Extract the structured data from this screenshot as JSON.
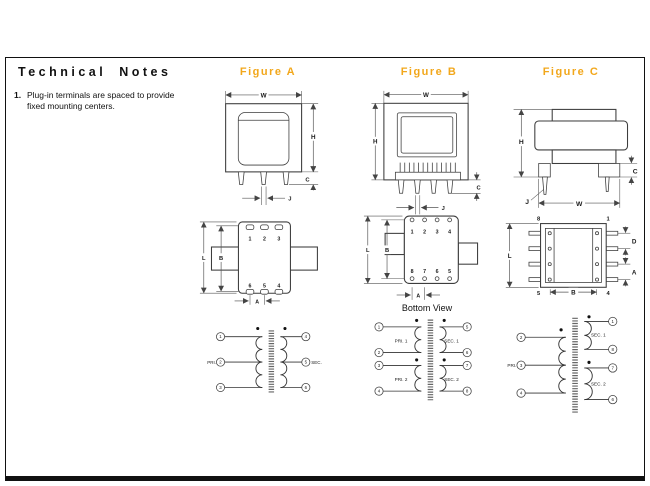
{
  "page": {
    "title": "Technical Notes",
    "note_1_num": "1.",
    "note_1_text": "Plug-in terminals are spaced to provide fixed mounting centers."
  },
  "colors": {
    "figure_title_accent": "#F2A71B",
    "line": "#444444"
  },
  "fig_a": {
    "title": "Figure A",
    "front": {
      "w": "W",
      "h": "H",
      "c": "C",
      "j": "J"
    },
    "bottom": {
      "top_pins": [
        "1",
        "2",
        "3"
      ],
      "bottom_pins": [
        "6",
        "5",
        "4"
      ],
      "l": "L",
      "b": "B",
      "a": "A"
    },
    "schem": {
      "left_pins": [
        "1",
        "2",
        "3"
      ],
      "right_pins": [
        "4",
        "5",
        "6"
      ],
      "pri": "PRI.",
      "sec": "SEC."
    }
  },
  "fig_b": {
    "title": "Figure B",
    "front": {
      "w": "W",
      "h": "H",
      "c": "C",
      "j": "J"
    },
    "bottom": {
      "caption": "Bottom View",
      "top_pins": [
        "1",
        "2",
        "3",
        "4"
      ],
      "bottom_pins": [
        "8",
        "7",
        "6",
        "5"
      ],
      "l": "L",
      "b": "B",
      "a": "A"
    },
    "schem": {
      "left_pins": [
        "1",
        "2",
        "3",
        "4"
      ],
      "right_pins": [
        "5",
        "6",
        "7",
        "8"
      ],
      "pri1": "PRI. 1",
      "pri2": "PRI. 2",
      "sec1": "SEC. 1",
      "sec2": "SEC. 2"
    }
  },
  "fig_c": {
    "title": "Figure C",
    "front": {
      "w": "W",
      "h": "H",
      "c": "C",
      "j": "J"
    },
    "bottom": {
      "tl": "8",
      "tr": "1",
      "bl": "5",
      "br": "4",
      "l": "L",
      "b": "B",
      "d": "D",
      "a": "A"
    },
    "schem": {
      "left_pins": [
        "2",
        "3",
        "4"
      ],
      "right_pins": [
        "1",
        "8",
        "7",
        "6"
      ],
      "pri": "PRI.",
      "sec1": "SEC. 1",
      "sec2": "SEC. 2"
    }
  }
}
